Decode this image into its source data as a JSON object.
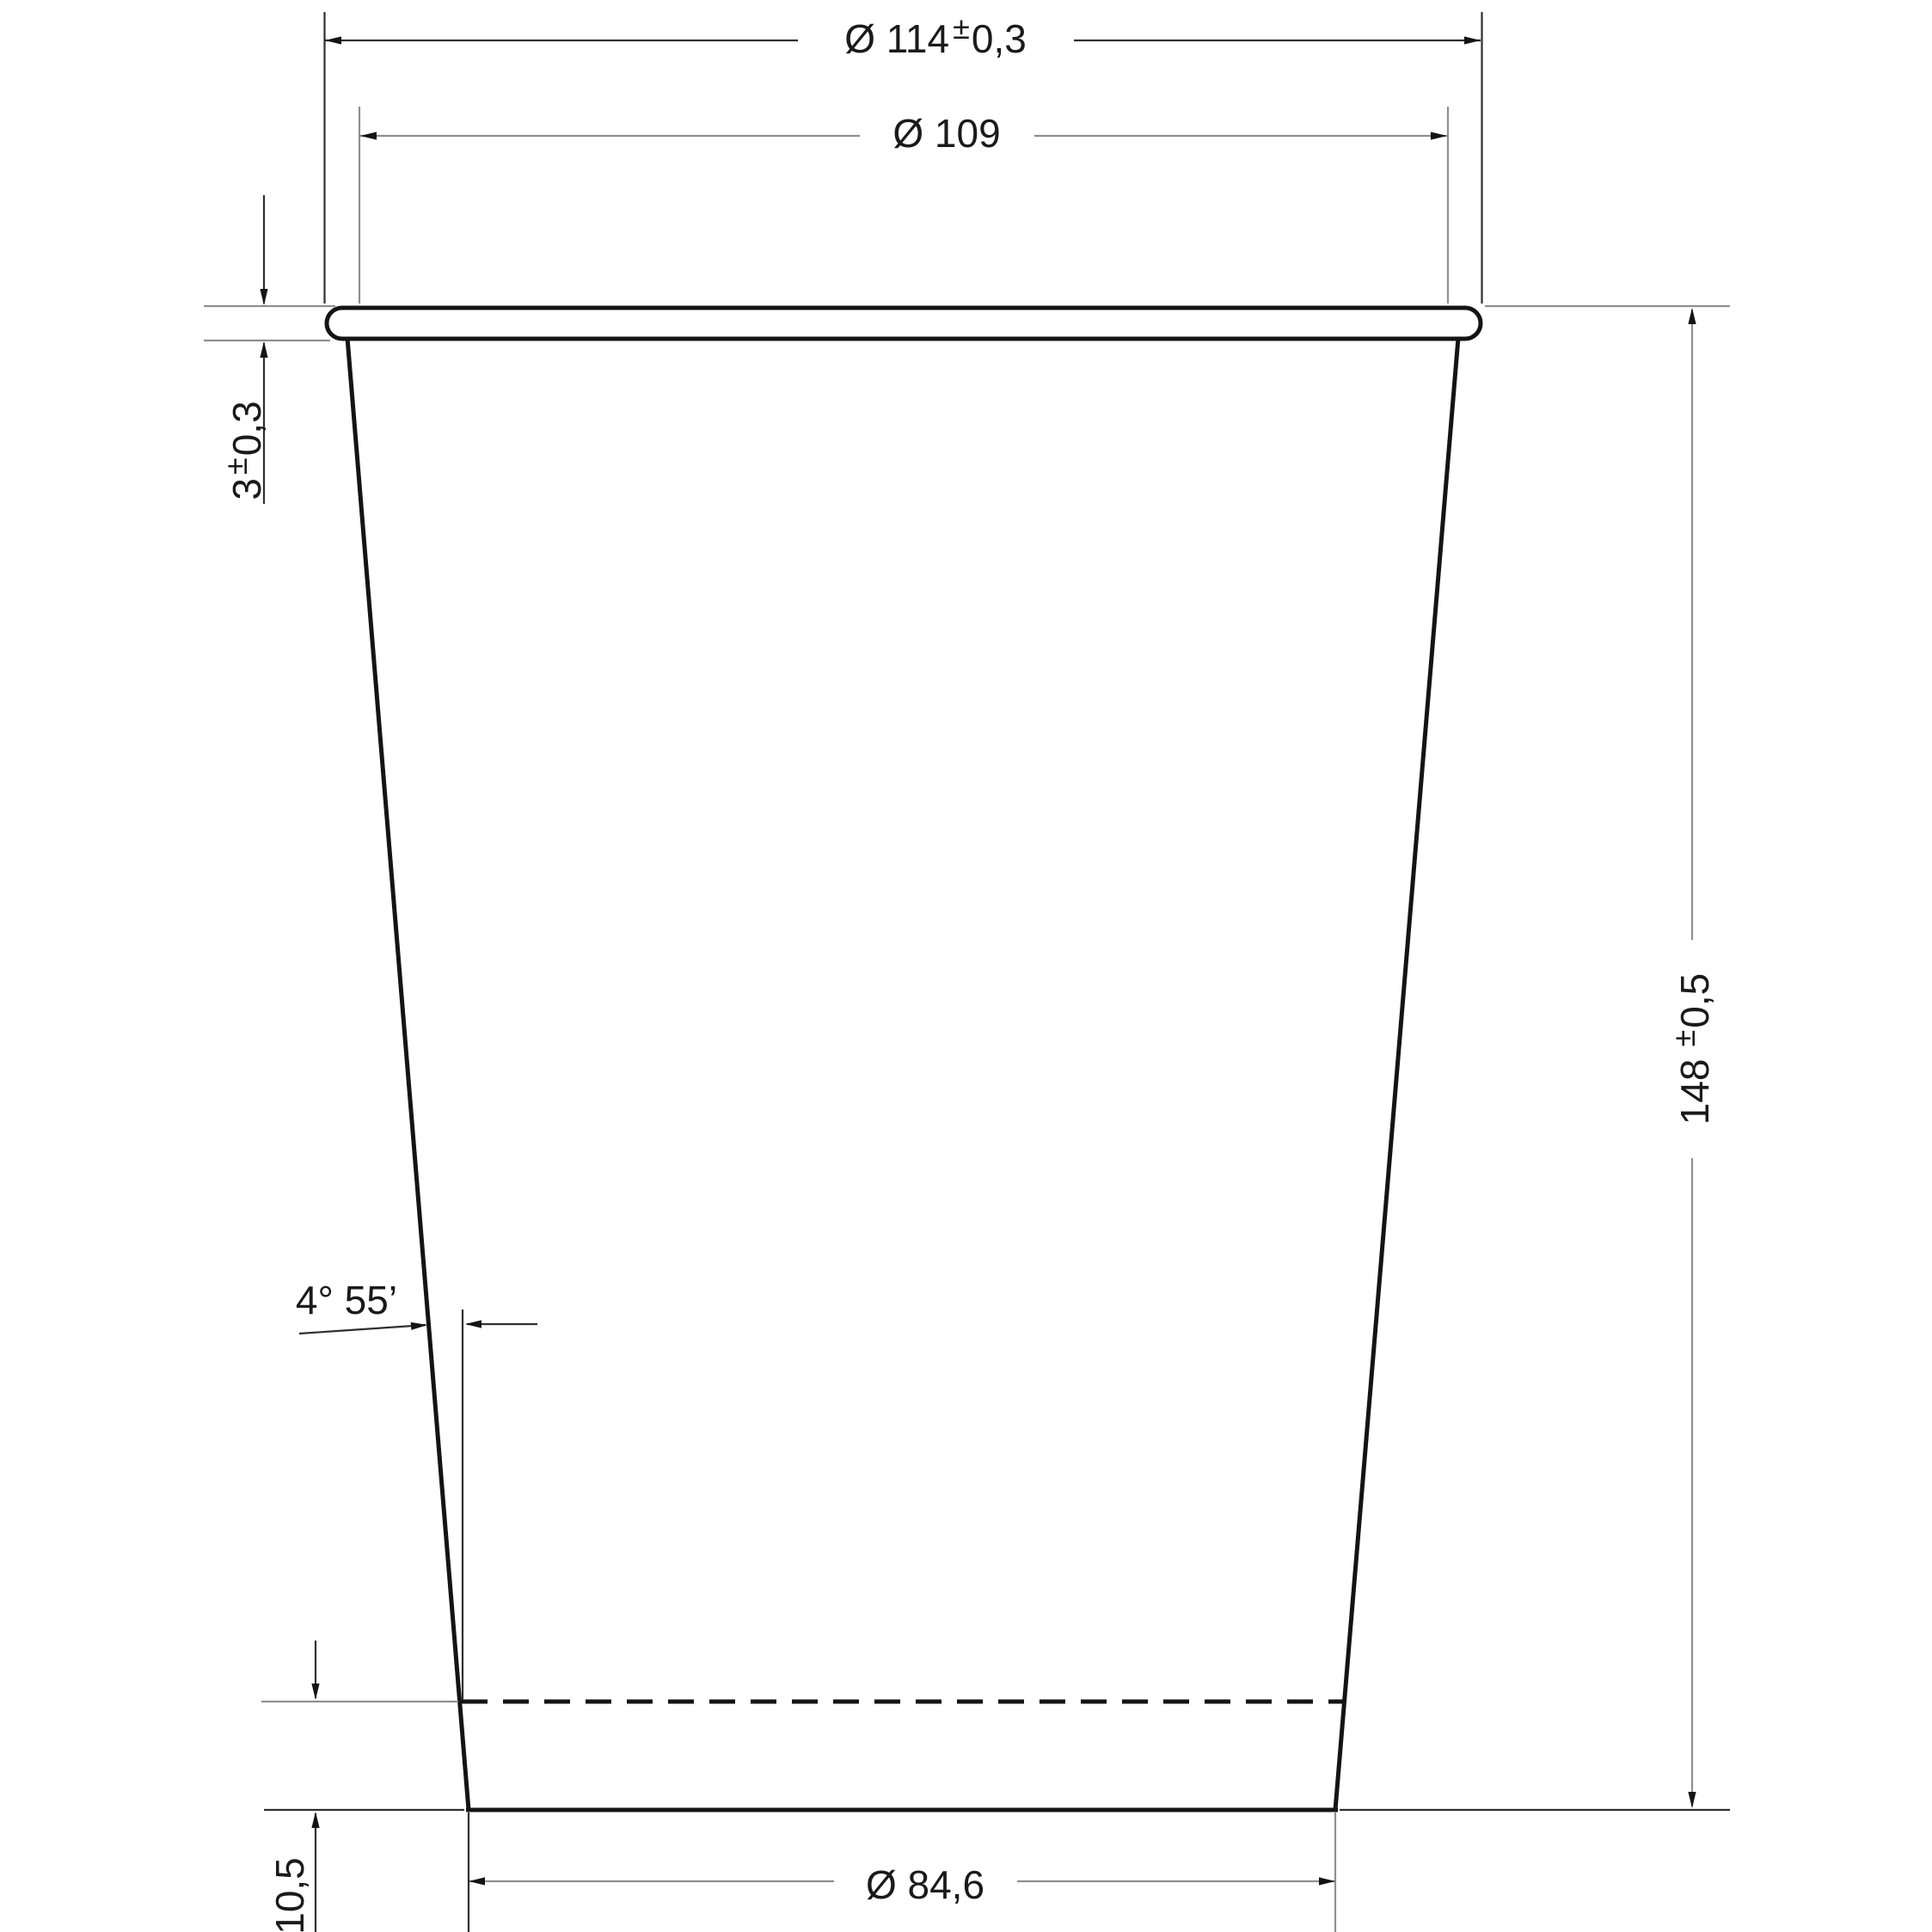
{
  "canvas": {
    "background": "#ffffff"
  },
  "colors": {
    "outline": "#141414",
    "dim_dark": "#2f2f2f",
    "dim_gray": "#8f8f8f",
    "text": "#1a1a1a",
    "fill": "#ffffff"
  },
  "labels": {
    "top_outer_diameter": {
      "prefix": "Ø 114",
      "sup": "±",
      "suffix": "0,3"
    },
    "top_inner_diameter": {
      "text": "Ø 109"
    },
    "rim_height": {
      "prefix": "3",
      "sup": "±",
      "suffix": "0,3"
    },
    "total_height": {
      "prefix": "148",
      "sup": "±",
      "suffix": "0,5"
    },
    "taper_angle": {
      "text": "4° 55’"
    },
    "bottom_inset_height": {
      "text": "10,5"
    },
    "bottom_diameter": {
      "text": "Ø 84,6"
    }
  }
}
